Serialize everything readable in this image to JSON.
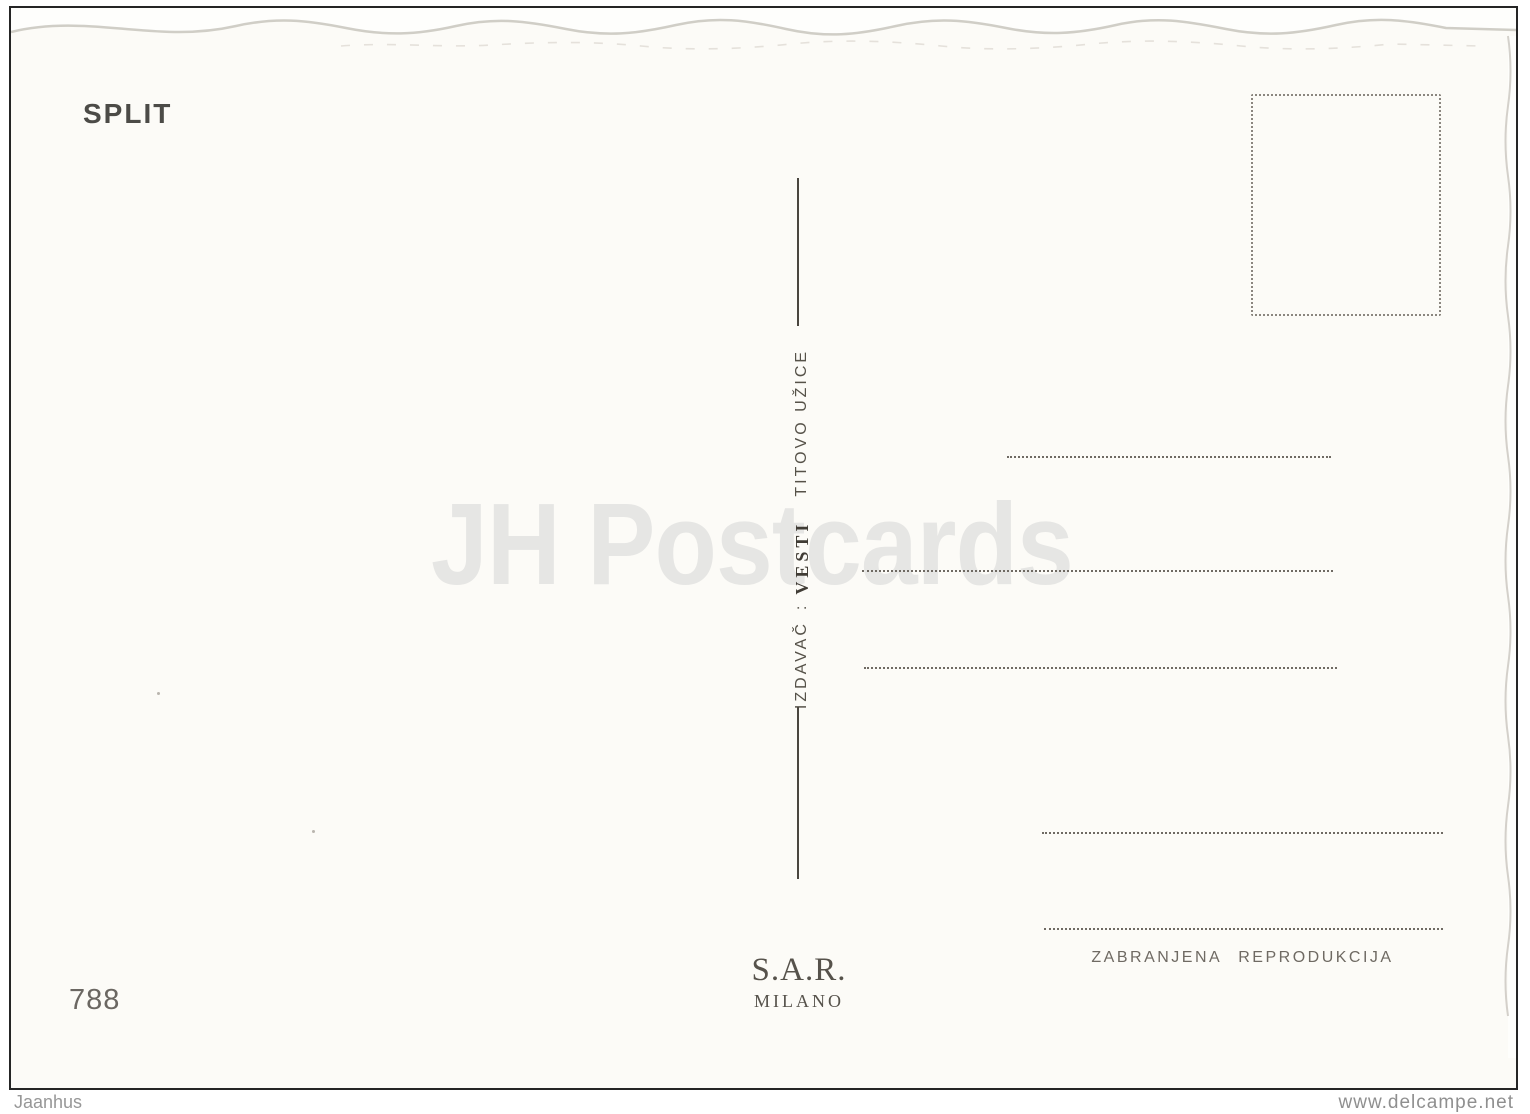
{
  "postcard": {
    "title": "SPLIT",
    "card_number": "788",
    "publisher": {
      "label": "IZDAVAČ",
      "separator": ":",
      "name": "VESTI",
      "city": "TITOVO UŽICE"
    },
    "printer": {
      "name": "S.A.R.",
      "city": "MILANO"
    },
    "notice": "ZABRANJENA REPRODUKCIJA"
  },
  "watermark": {
    "text": "JH Postcards"
  },
  "footer": {
    "left": "Jaanhus",
    "right": "www.delcampe.net"
  },
  "colors": {
    "card_background": "#fcfbf7",
    "frame": "#252525",
    "ink": "#55504a",
    "dotted_lines": "#6f6a63",
    "watermark": "#e6e6e4",
    "deckle_edge": "#c8c5bd",
    "footer_text": "#979797"
  }
}
